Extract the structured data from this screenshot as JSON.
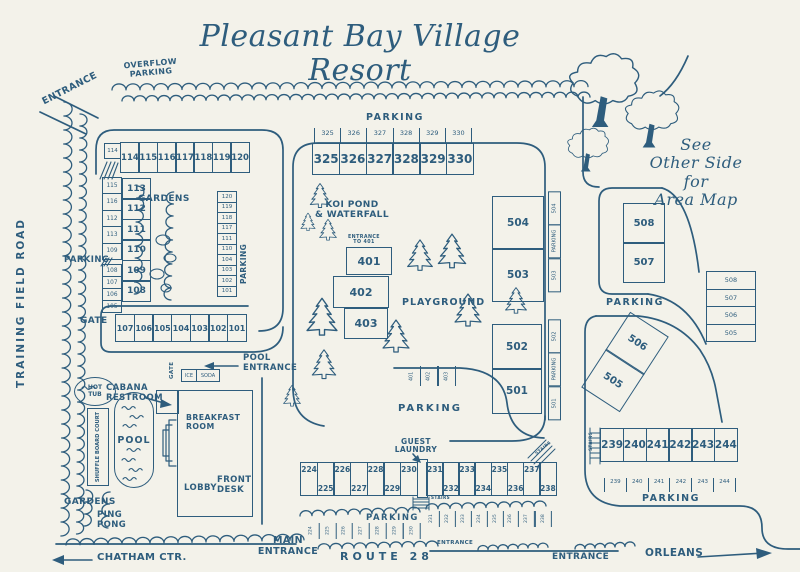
{
  "colors": {
    "ink": "#2e5d7d",
    "paper": "#f3f2ea"
  },
  "title": "Pleasant Bay Village Resort",
  "labels": {
    "overflow": "OVERFLOW\nPARKING",
    "entrance_top": "ENTRANCE",
    "training_road": "TRAINING FIELD ROAD",
    "parking_upper_left": "PARKING",
    "gardens_upper": "GARDENS",
    "parking_garden_col": "PARKING",
    "gate_upper": "GATE",
    "pool_entrance": "POOL\nENTRANCE",
    "gate_pool": "GATE",
    "ice": "ICE",
    "soda": "SODA",
    "hot_tub": "HOT\nTUB",
    "cabana": "CABANA\nRESTROOM",
    "pool": "POOL",
    "shuffleboard": "SHUFFLE BOARD COURT",
    "breakfast": "BREAKFAST\nROOM",
    "lobby": "LOBBY",
    "front_desk": "FRONT\nDESK",
    "gardens_lower": "GARDENS",
    "ping_pong": "PING\nPONG",
    "parking_325": "PARKING",
    "koi": "KOI POND\n& WATERFALL",
    "entrance_401": "ENTRANCE\nTO 401",
    "playground": "PLAYGROUND",
    "parking_mid": "PARKING",
    "guest_laundry": "GUEST\nLAUNDRY",
    "stairs_mid": "STAIRS",
    "stairs_diag": "STAIRS",
    "stairs_239": "STAIRS",
    "see_other": "See\nOther Side\nfor\nArea Map",
    "parking_508": "PARKING",
    "parking_239": "PARKING",
    "parking_bottom": "PARKING",
    "main_entrance": "MAIN\nENTRANCE",
    "chatham": "CHATHAM CTR.",
    "route_28": "ROUTE 28",
    "orleans": "ORLEANS",
    "entrance_small": "ENTRANCE",
    "entrance_bottom": "ENTRANCE"
  },
  "buildings": {
    "row_114": [
      "114",
      "115",
      "116",
      "117",
      "118",
      "119",
      "120"
    ],
    "col_108": [
      "113",
      "112",
      "111",
      "110",
      "109",
      "108"
    ],
    "row_101": [
      "107",
      "106",
      "105",
      "104",
      "103",
      "102",
      "101"
    ],
    "row_325": [
      "325",
      "326",
      "327",
      "328",
      "329",
      "330"
    ],
    "mid": [
      "401",
      "402",
      "403"
    ],
    "col_503": [
      "504",
      "503"
    ],
    "col_501": [
      "502",
      "501"
    ],
    "col_507": [
      "508",
      "507"
    ],
    "tilted": [
      "506",
      "505"
    ],
    "row_239": [
      "239",
      "240",
      "241",
      "242",
      "243",
      "244"
    ],
    "row_230": [
      "224",
      "225",
      "226",
      "227",
      "228",
      "229",
      "230"
    ],
    "row_238": [
      "231",
      "232",
      "233",
      "234",
      "235",
      "236",
      "237",
      "238"
    ]
  },
  "stalls": {
    "s114": "114",
    "left_a": [
      "115",
      "116",
      "112",
      "113",
      "109"
    ],
    "left_b": [
      "108",
      "107",
      "106",
      "105"
    ],
    "garden_col": [
      "120",
      "119",
      "118",
      "117",
      "111",
      "110",
      "104",
      "103",
      "102",
      "101"
    ],
    "row_325": [
      "325",
      "326",
      "327",
      "328",
      "329",
      "330"
    ],
    "strip_503": [
      "504",
      "PARKING",
      "503"
    ],
    "strip_501": [
      "502",
      "PARKING",
      "501"
    ],
    "mid_small": [
      "401",
      "402",
      "403"
    ],
    "right_col": [
      "508",
      "507",
      "506",
      "505"
    ],
    "row_239": [
      "239",
      "240",
      "241",
      "242",
      "243",
      "244"
    ],
    "bottom_a": [
      "224",
      "225",
      "226",
      "227",
      "228",
      "229",
      "230"
    ],
    "bottom_b": [
      "231",
      "232",
      "233",
      "234",
      "235",
      "236",
      "237",
      "238"
    ]
  }
}
